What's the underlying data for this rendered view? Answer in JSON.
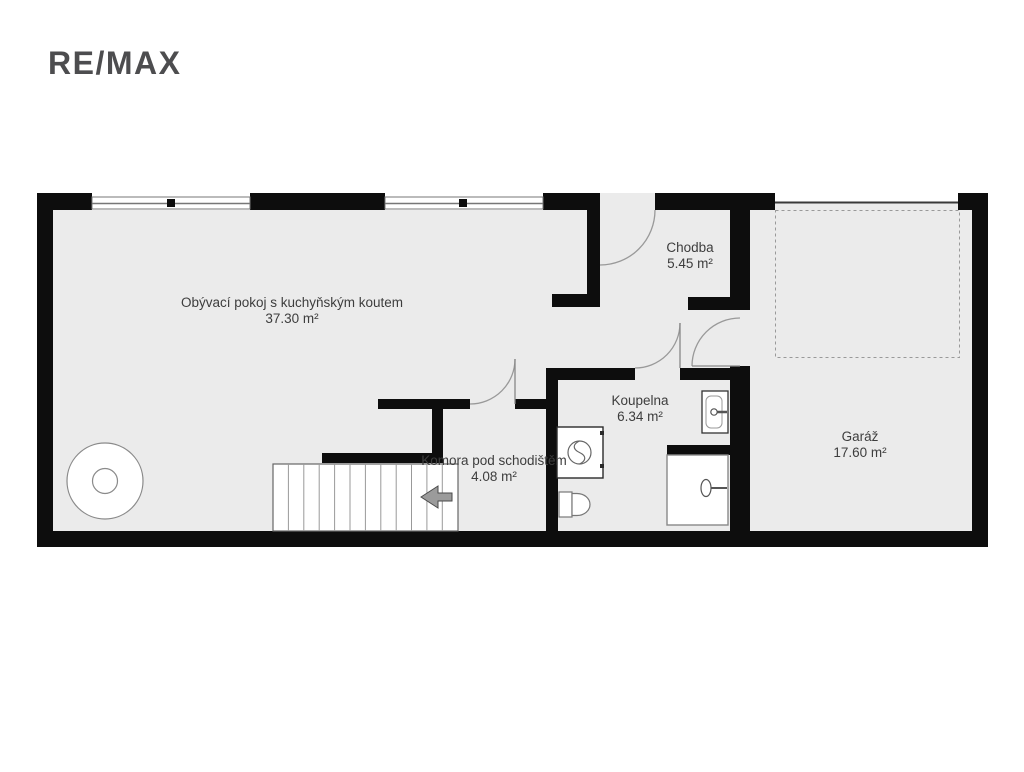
{
  "logo": {
    "text": "RE/MAX"
  },
  "rooms": [
    {
      "name": "Obývací pokoj s kuchyňským koutem",
      "area": "37.30 m²"
    },
    {
      "name": "Chodba",
      "area": "5.45 m²"
    },
    {
      "name": "Koupelna",
      "area": "6.34 m²"
    },
    {
      "name": "Komora pod schodištěm",
      "area": "4.08 m²"
    },
    {
      "name": "Garáž",
      "area": "17.60 m²"
    }
  ],
  "colors": {
    "wall": "#0d0d0d",
    "floor": "#ebebeb",
    "label_text": "#3d3d3d",
    "logo_text": "#4d4d4f",
    "door_arc": "#999999",
    "fixture_outline": "#777777"
  }
}
